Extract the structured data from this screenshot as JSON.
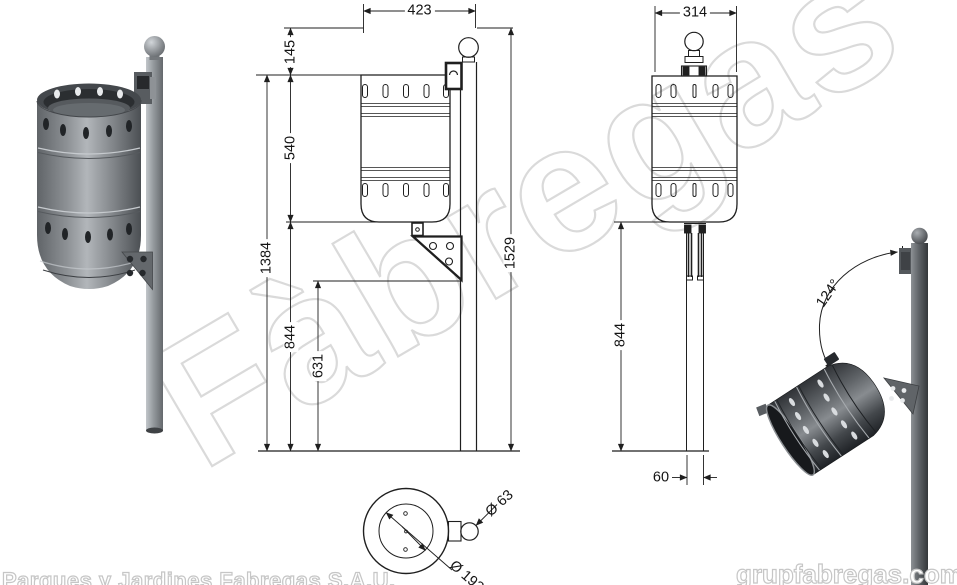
{
  "watermark": {
    "text": "Fàbregas"
  },
  "footer": {
    "company": "Parques y Jardines Fabregas S.A.U.",
    "website": "grupfabregas.com"
  },
  "dimensions": {
    "front": {
      "top_width": "423",
      "top_offset": "145",
      "bin_height": "540",
      "bin_top_to_ground": "1384",
      "bracket_to_ground": "844",
      "bracket_bottom_to_ground": "631",
      "overall_height": "1529"
    },
    "side": {
      "bin_depth": "314",
      "pole_height": "844",
      "pole_width": "60"
    },
    "top": {
      "bin_diameter": "Ø 192",
      "pole_diameter": "Ø 63"
    },
    "tilt": {
      "angle": "124°"
    }
  },
  "colors": {
    "line": "#1f1f1f",
    "watermark_outline": "#dadada",
    "bin_gray": "#8f9397",
    "bin_dark_gray": "#43474b"
  }
}
